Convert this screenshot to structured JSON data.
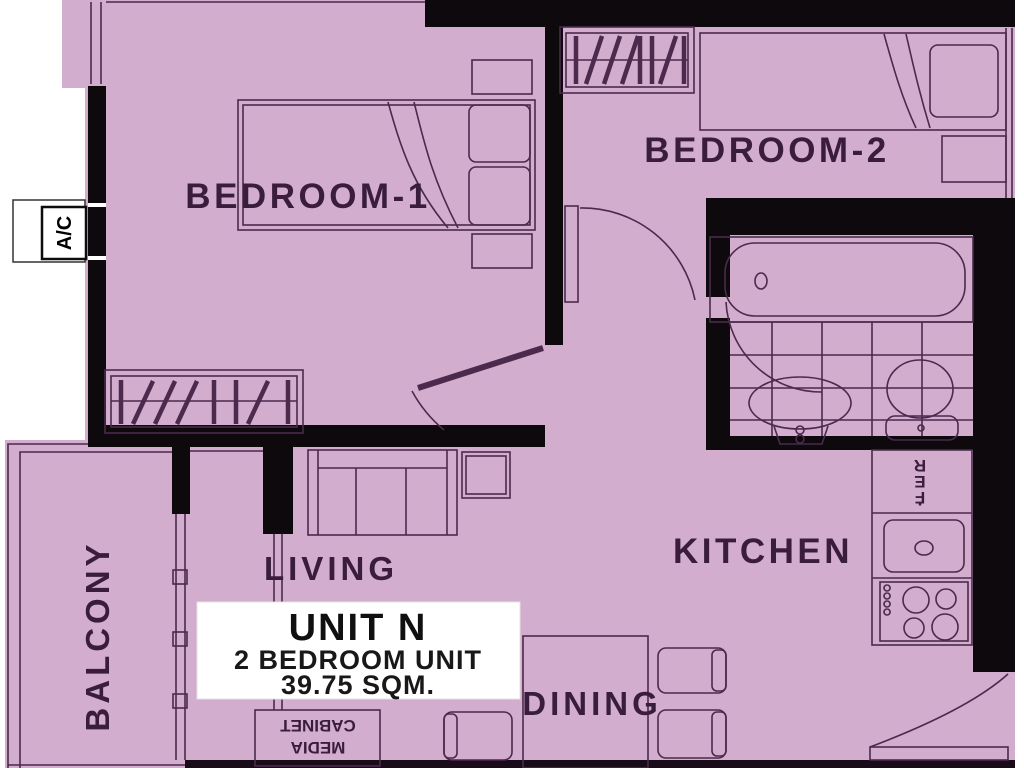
{
  "unit_label": {
    "name": "UNIT N",
    "type": "2 BEDROOM UNIT",
    "area": "39.75 SQM."
  },
  "rooms": {
    "bedroom1": "BEDROOM-1",
    "bedroom2": "BEDROOM-2",
    "living": "LIVING",
    "kitchen": "KITCHEN",
    "dining": "DINING",
    "balcony": "BALCONY"
  },
  "fixtures": {
    "ac": "A/C",
    "ref_letters": [
      "R",
      "E",
      "F",
      "."
    ],
    "media_cabinet": {
      "line1": "MEDIA",
      "line2": "CABINET"
    }
  },
  "colors": {
    "floor": "#d2adce",
    "wall": "#0d090d",
    "line": "#4b2a4d",
    "label": "#3a1d3c",
    "background": "#ffffff"
  }
}
